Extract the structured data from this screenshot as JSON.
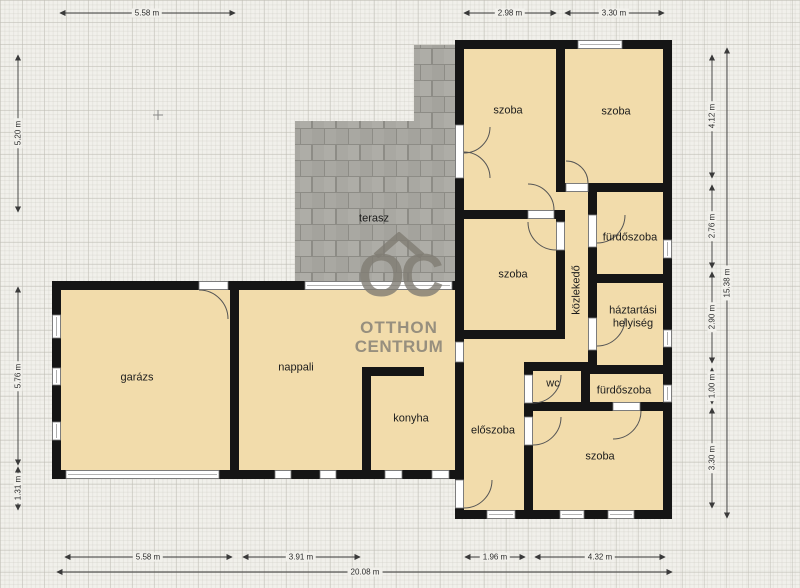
{
  "rooms": {
    "garage": "garázs",
    "living": "nappali",
    "kitchen": "konyha",
    "terrace": "terasz",
    "bedroom_top_left": "szoba",
    "bedroom_top_right": "szoba",
    "bedroom_middle": "szoba",
    "bedroom_bottom": "szoba",
    "bathroom_upper": "fürdőszoba",
    "bathroom_lower": "fürdőszoba",
    "hallway": "közlekedő",
    "utility": "háztartási helyiség",
    "wc": "wc",
    "entry": "előszoba"
  },
  "dims": {
    "top_1": "5.58 m",
    "top_2": "2.98 m",
    "top_3": "3.30 m",
    "left_1": "5.20 m",
    "left_2": "5.76 m",
    "left_3": "1.31 m",
    "right_1": "4.12 m",
    "right_2": "2.76 m",
    "right_3": "2.90 m",
    "right_4": "1.00 m",
    "right_5": "3.30 m",
    "right_total": "15.38 m",
    "bottom_1": "5.58 m",
    "bottom_2": "3.91 m",
    "bottom_3": "1.96 m",
    "bottom_4": "4.32 m",
    "bottom_total": "20.08 m"
  },
  "watermark": {
    "oc": "OC",
    "line1": "OTTHON",
    "line2": "CENTRUM"
  },
  "colors": {
    "room_fill": "#f2dcab",
    "wall": "#151515",
    "terrace": "#a9a8a2",
    "paper": "#f1f0eb",
    "watermark": "#807c73"
  }
}
